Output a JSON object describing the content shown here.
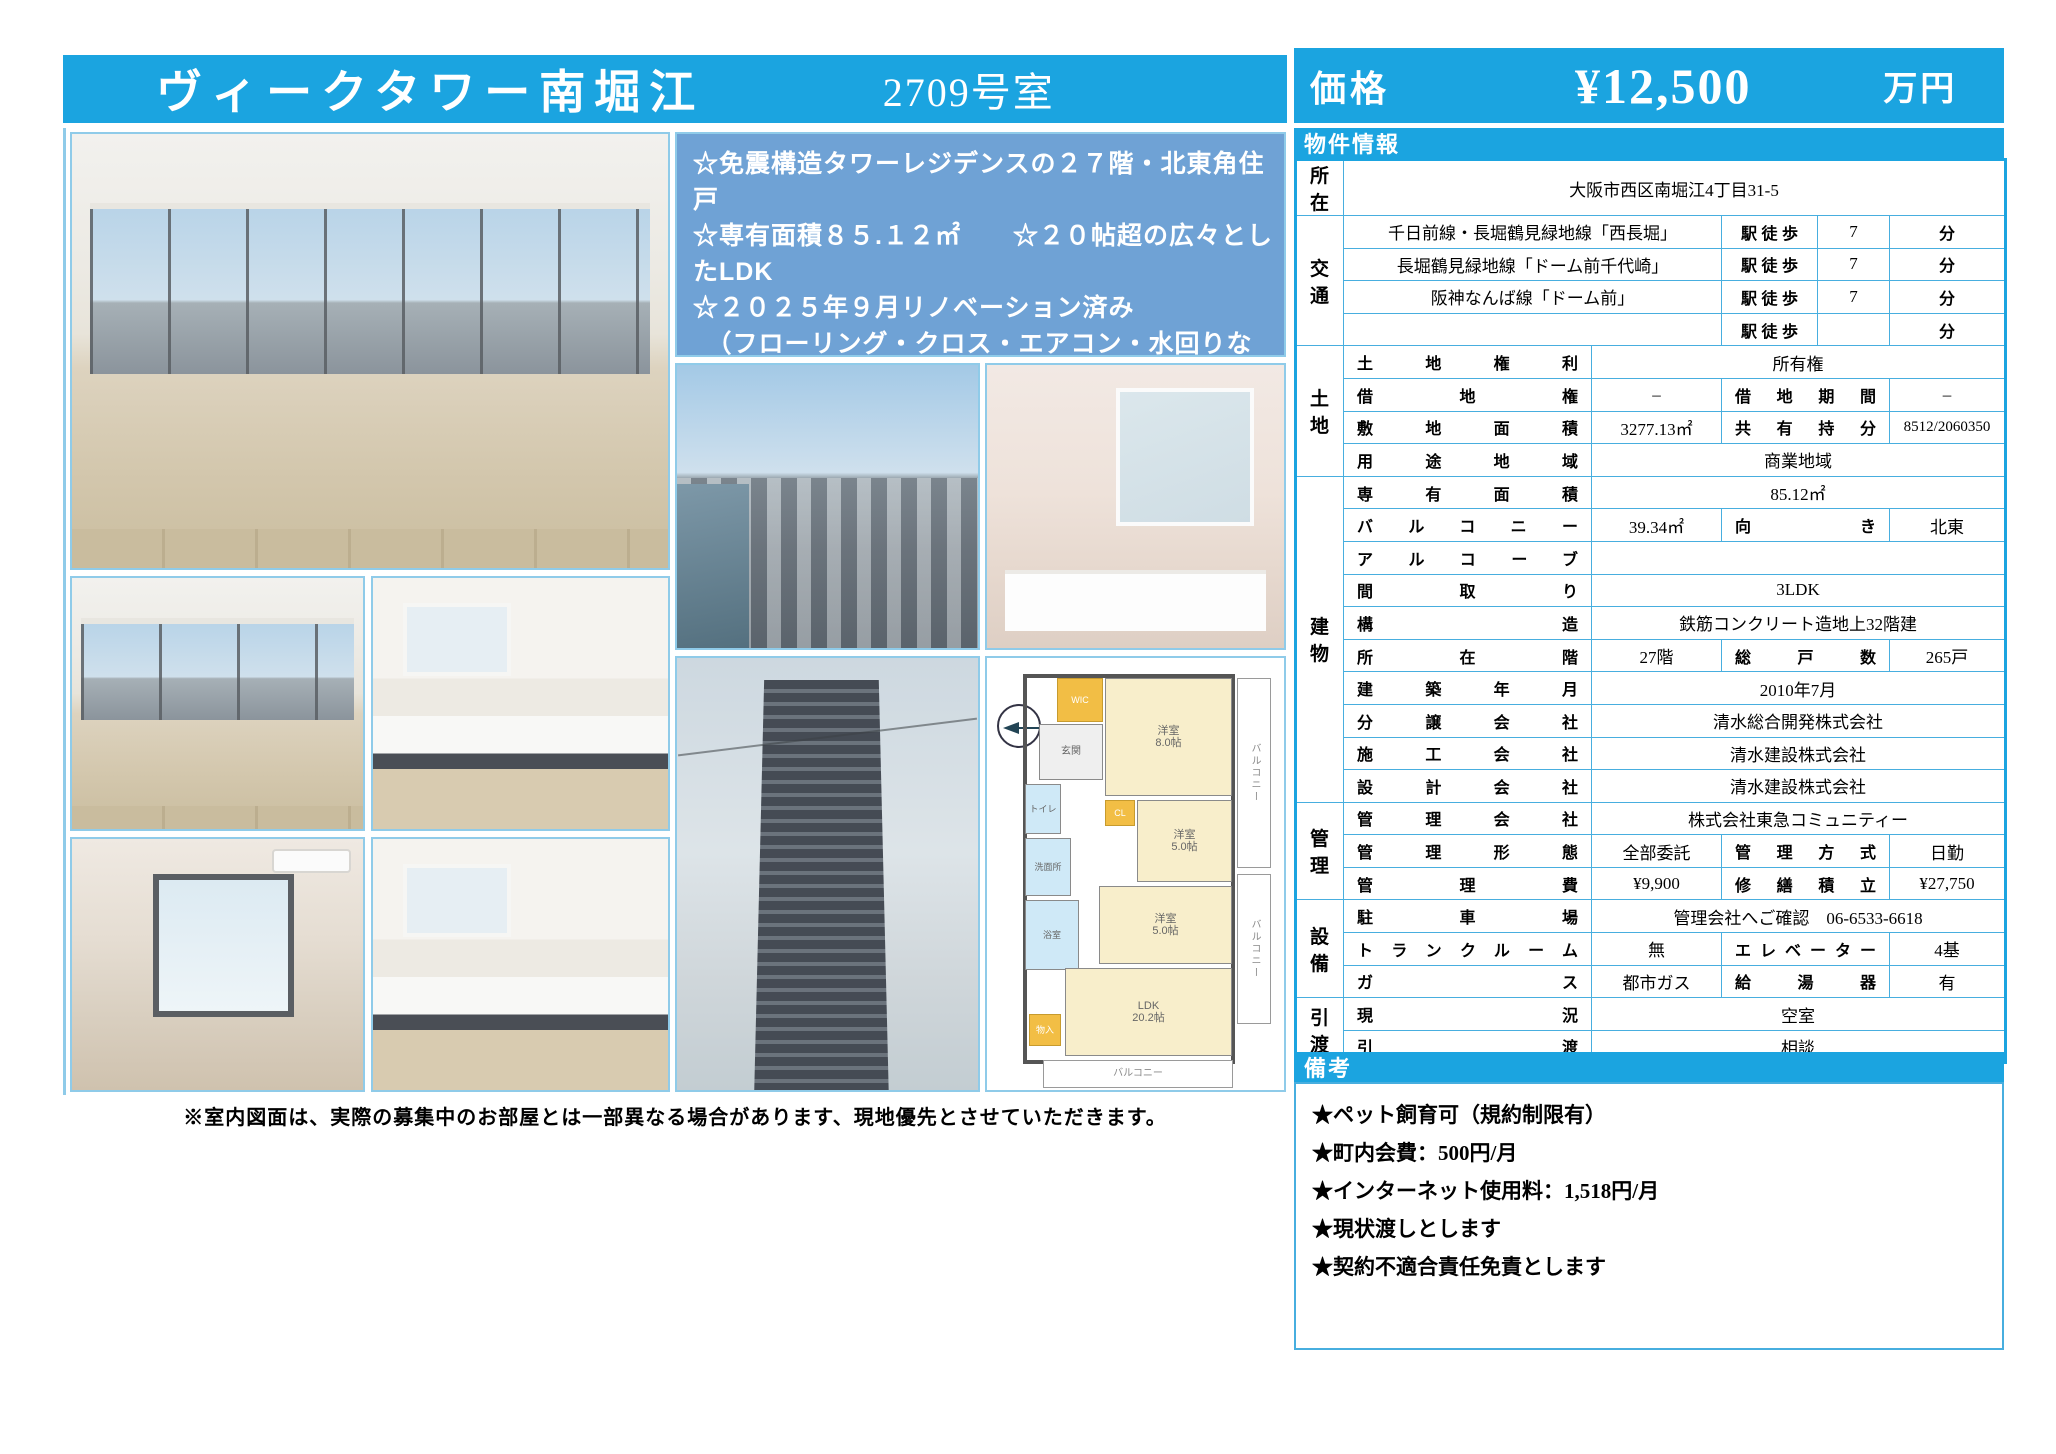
{
  "header": {
    "building_name": "ヴィークタワー南堀江",
    "room_label": "2709号室"
  },
  "price": {
    "label": "価格",
    "amount": "¥12,500",
    "unit": "万円"
  },
  "sections": {
    "property": "物件情報",
    "remarks": "備考"
  },
  "features": {
    "line1": "☆免震構造タワーレジデンスの２７階・北東角住戸",
    "line2": "☆専有面積８５.１２㎡　　☆２０帖超の広々としたLDK",
    "line3": "☆２０２５年９月リノベーション済み",
    "line4": "　（フローリング・クロス・エアコン・水回りなど新調）",
    "line5": "☆２４時間各階にてゴミ出し可能",
    "line6": "☆３路線３駅利用可能・心斎橋生活圏内・生活至便"
  },
  "caption": "※室内図面は、実際の募集中のお部屋とは一部異なる場合があります、現地優先とさせていただきます。",
  "table": {
    "location": {
      "label": "所 在",
      "value": "大阪市西区南堀江4丁目31-5"
    },
    "access": {
      "label": "交 通",
      "walk_label": "駅 徒 歩",
      "minute_label": "分",
      "rows": [
        {
          "line": "千日前線・長堀鶴見緑地線「西長堀」",
          "minutes": "7"
        },
        {
          "line": "長堀鶴見緑地線「ドーム前千代崎」",
          "minutes": "7"
        },
        {
          "line": "阪神なんば線「ドーム前」",
          "minutes": "7"
        },
        {
          "line": "",
          "minutes": ""
        }
      ]
    },
    "land": {
      "label": "土 地",
      "rights": {
        "label": "土地権利",
        "value": "所有権"
      },
      "lease": {
        "label": "借地権",
        "value": "–",
        "label2": "借地期間",
        "value2": "–"
      },
      "area": {
        "label": "敷地面積",
        "value": "3277.13㎡",
        "label2": "共有持分",
        "value2": "8512/2060350"
      },
      "zoning": {
        "label": "用途地域",
        "value": "商業地域"
      }
    },
    "building": {
      "label": "建 物",
      "senyu": {
        "label": "専有面積",
        "value": "85.12㎡"
      },
      "balcony": {
        "label": "バルコニー",
        "value": "39.34㎡",
        "label2": "向き",
        "value2": "北東"
      },
      "alcove": {
        "label": "アルコーブ",
        "value": ""
      },
      "madori": {
        "label": "間取り",
        "value": "3LDK"
      },
      "kozo": {
        "label": "構造",
        "value": "鉄筋コンクリート造地上32階建"
      },
      "floor": {
        "label": "所在階",
        "value": "27階",
        "label2": "総戸数",
        "value2": "265戸"
      },
      "built": {
        "label": "建築年月",
        "value": "2010年7月"
      },
      "developer": {
        "label": "分譲会社",
        "value": "清水総合開発株式会社"
      },
      "constructor": {
        "label": "施工会社",
        "value": "清水建設株式会社"
      },
      "designer": {
        "label": "設計会社",
        "value": "清水建設株式会社"
      }
    },
    "management": {
      "label": "管 理",
      "company": {
        "label": "管理会社",
        "value": "株式会社東急コミュニティー"
      },
      "keitai": {
        "label": "管理形態",
        "value": "全部委託",
        "label2": "管理方式",
        "value2": "日勤"
      },
      "fee": {
        "label": "管理費",
        "value": "¥9,900",
        "label2": "修繕積立",
        "value2": "¥27,750"
      }
    },
    "facility": {
      "label": "設 備",
      "parking": {
        "label": "駐車場",
        "value": "管理会社へご確認　06-6533-6618"
      },
      "trunk": {
        "label": "トランクルーム",
        "value": "無",
        "label2": "エレベーター",
        "value2": "4基"
      },
      "gas": {
        "label": "ガス",
        "value": "都市ガス",
        "label2": "給湯器",
        "value2": "有"
      }
    },
    "handover": {
      "label": "引 渡",
      "genkyo": {
        "label": "現況",
        "value": "空室"
      },
      "hikiwatashi": {
        "label": "引渡",
        "value": "相談"
      }
    }
  },
  "remarks": [
    "★ペット飼育可（規約制限有）",
    "★町内会費：500円/月",
    "★インターネット使用料：1,518円/月",
    "★現状渡しとします",
    "★契約不適合責任免責とします"
  ],
  "floorplan": {
    "wic": "WIC",
    "entrance": "玄関",
    "bedroom1": "洋室",
    "bedroom1_size": "8.0帖",
    "toilet": "トイレ",
    "washroom": "洗面所",
    "bathroom": "浴室",
    "closet": "CL",
    "bedroom2": "洋室",
    "bedroom2_size": "5.0帖",
    "bedroom3": "洋室",
    "bedroom3_size": "5.0帖",
    "ldk": "LDK",
    "ldk_size": "20.2帖",
    "balcony": "バルコニー",
    "storage": "物入"
  },
  "colors": {
    "header_blue": "#1BA4E0",
    "feature_blue": "#6FA2D5",
    "border_blue": "#47AEDF"
  }
}
